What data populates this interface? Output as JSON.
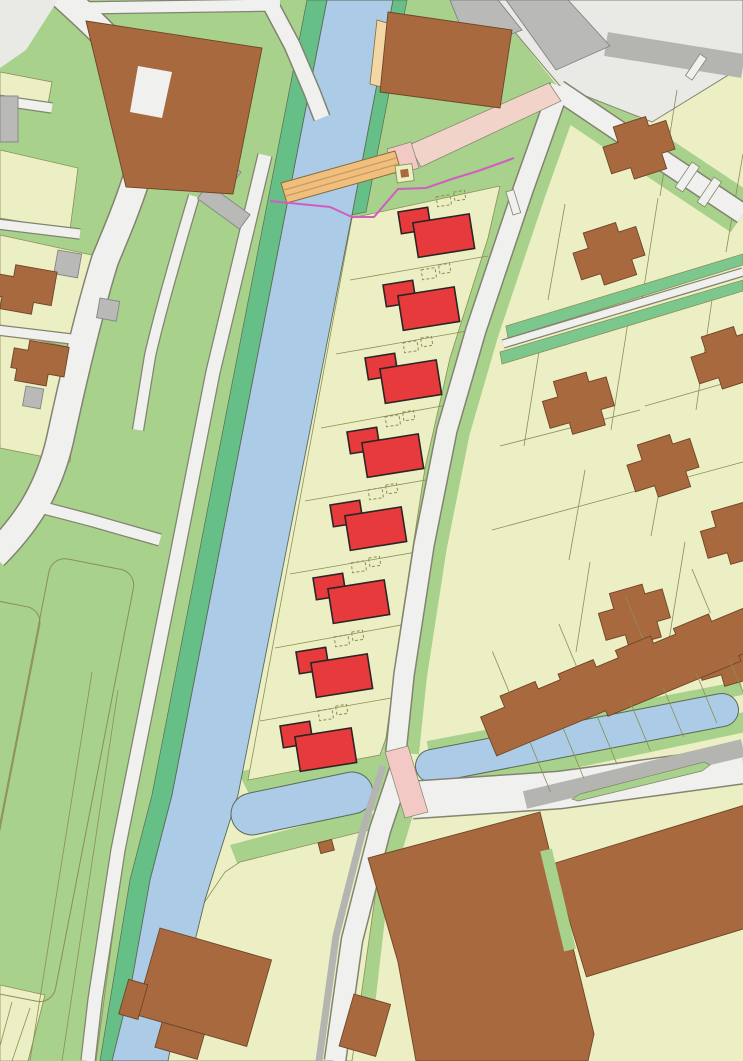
{
  "palette": {
    "parcel": "#ecefc3",
    "parcel_line": "#8b8f55",
    "grass": "#a8d18c",
    "grass_dark": "#66bf87",
    "hedge": "#7cc78e",
    "water": "#abcbe7",
    "water_edge": "#5c6a54",
    "road": "#f0f0ee",
    "road_casing": "#83836f",
    "road_dark": "#b4b4b1",
    "plaza": "#e9e9e6",
    "building_existing": "#a8693f",
    "building_existing_outline": "#6f4526",
    "building_secondary": "#b9b9b7",
    "building_secondary_outline": "#84848a",
    "building_new": "#e73a3c",
    "building_new_outline": "#2b2524",
    "bridge": "#f0bf7e",
    "bridge_outline": "#8a6a38",
    "bridge_deck_line": "#c89a5e",
    "quay": "#f3d7a4",
    "path_pink": "#f1d3c9",
    "crossing_pink": "#f3c9c5",
    "fence_magenta": "#d15dc3"
  },
  "features": {
    "planned_houses": {
      "count": 8,
      "color_key": "building_new",
      "extension_outline_boxes_per_house": 2
    },
    "canal": {
      "color_key": "water",
      "orientation": "diagonal-NE-SW"
    },
    "water_branches": {
      "count": 2
    },
    "bridge": {
      "count": 1,
      "color_key": "bridge"
    },
    "hedgerows": {
      "count": 2,
      "color_key": "hedge"
    },
    "terraced_row_units": 7,
    "park_fields": {
      "count": 2
    },
    "existing_building_color_key": "building_existing"
  }
}
